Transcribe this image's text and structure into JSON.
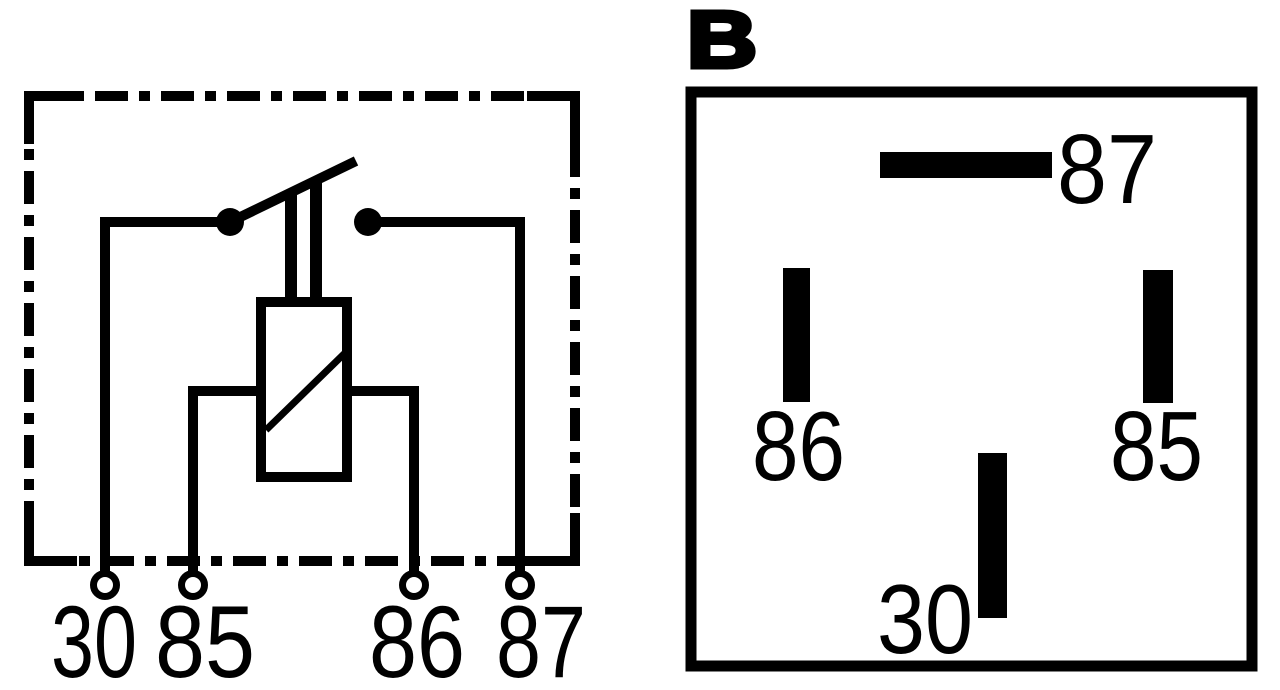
{
  "page": {
    "background": "#ffffff",
    "ink": "#000000",
    "description": "Automotive relay wiring diagram: internal circuit schematic (left) and pin/terminal layout B (right)"
  },
  "schematic": {
    "kind": "relay-internal-circuit",
    "border_style": "dash-dot",
    "terminals": [
      {
        "label": "30"
      },
      {
        "label": "85"
      },
      {
        "label": "86"
      },
      {
        "label": "87"
      }
    ]
  },
  "pin_layout": {
    "title": "B",
    "pins": [
      {
        "label": "87",
        "orientation": "horizontal",
        "position": "top-center"
      },
      {
        "label": "86",
        "orientation": "vertical",
        "position": "middle-left"
      },
      {
        "label": "85",
        "orientation": "vertical",
        "position": "middle-right"
      },
      {
        "label": "30",
        "orientation": "vertical",
        "position": "bottom-center"
      }
    ]
  }
}
